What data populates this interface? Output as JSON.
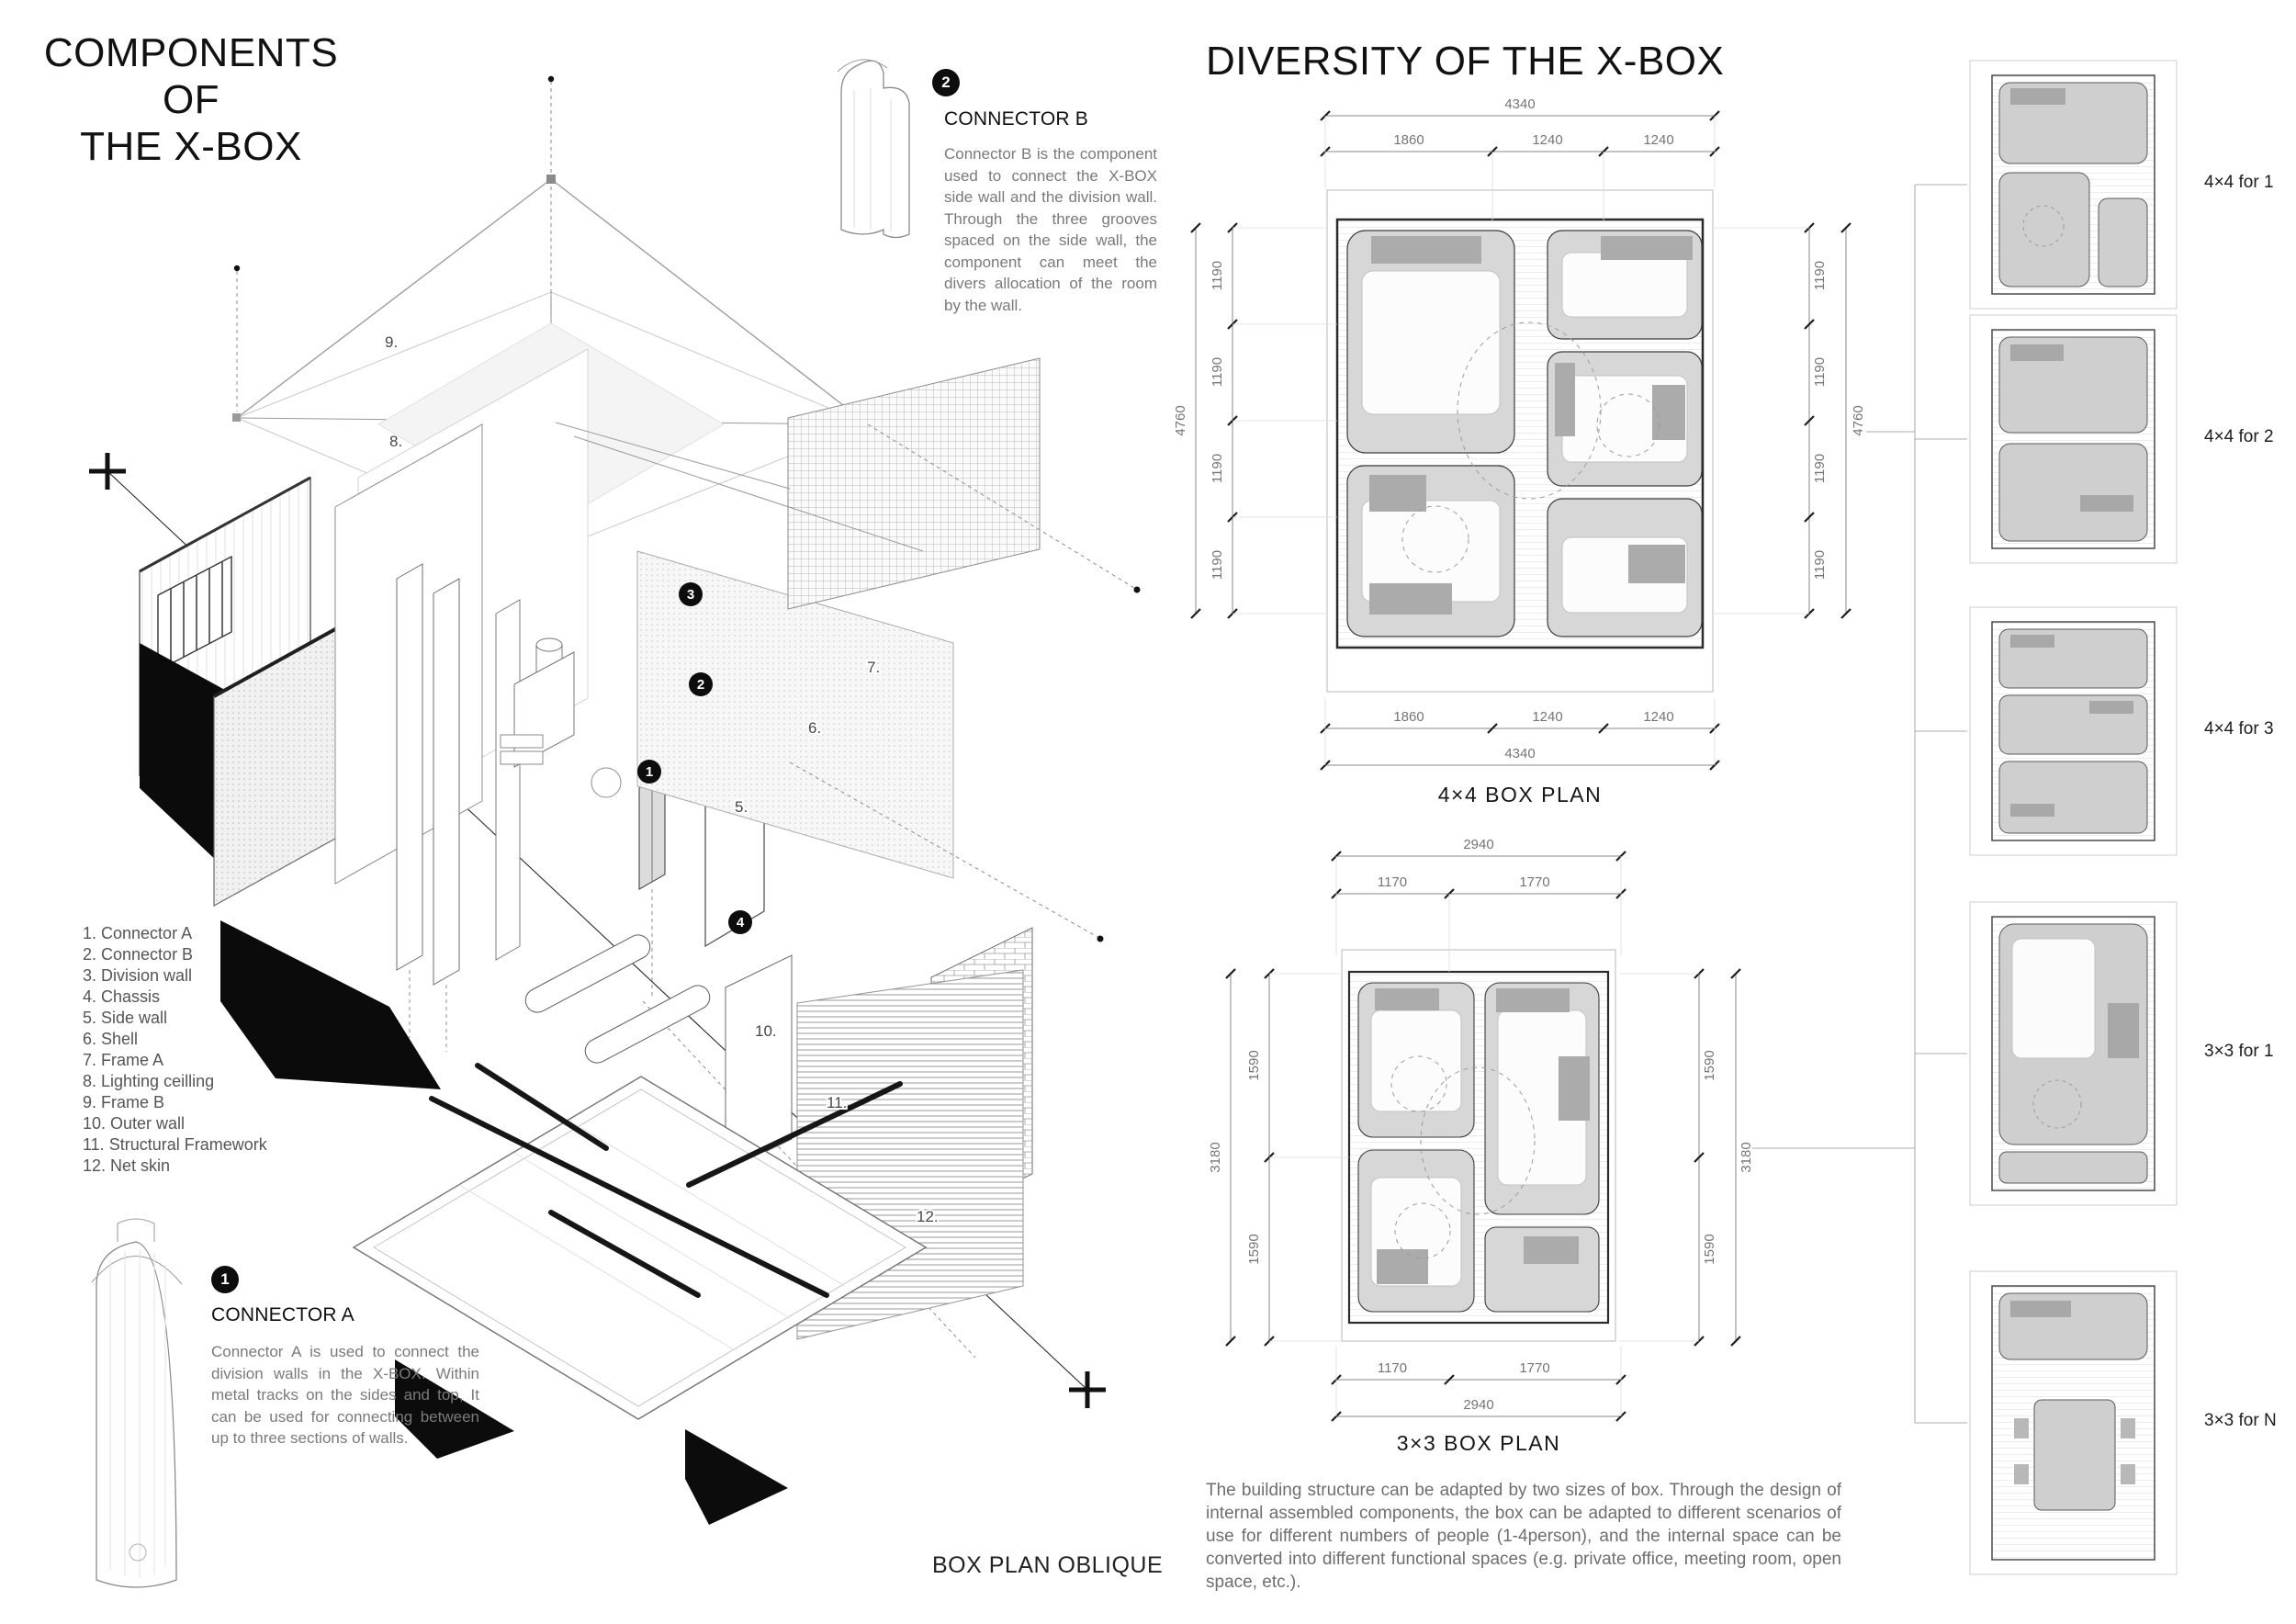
{
  "components": {
    "title1": "COMPONENTS OF",
    "title2": "THE X-BOX",
    "parts_list": [
      "1. Connector A",
      "2. Connector B",
      "3. Division wall",
      "4. Chassis",
      "5. Side wall",
      "6. Shell",
      "7. Frame A",
      "8. Lighting ceilling",
      "9. Frame B",
      "10. Outer wall",
      "11. Structural Framework",
      "12. Net skin"
    ],
    "connector_b": {
      "badge": "2",
      "heading": "CONNECTOR B",
      "body": "Connector B is the component used to connect the X-BOX side wall and the division wall. Through the three grooves spaced on the side wall, the component can meet the divers allocation of the room by the wall."
    },
    "connector_a": {
      "badge": "1",
      "heading": "CONNECTOR A",
      "body": "Connector A is used to connect the division walls in the X-BOX. Within metal tracks on the sides and top, It can be used for connecting between up to three sections of walls."
    },
    "callouts": {
      "badges": [
        "1",
        "2",
        "3",
        "4"
      ],
      "plain": [
        "5.",
        "6.",
        "7.",
        "8.",
        "9.",
        "10.",
        "11.",
        "12."
      ]
    },
    "oblique_label": "BOX PLAN OBLIQUE"
  },
  "diversity": {
    "title": "DIVERSITY OF THE X-BOX",
    "plan44": {
      "label": "4×4 BOX PLAN",
      "total_w": "4340",
      "top": [
        "1860",
        "1240",
        "1240"
      ],
      "total_h": "4760",
      "side": [
        "1190",
        "1190",
        "1190",
        "1190"
      ]
    },
    "plan33": {
      "label": "3×3 BOX PLAN",
      "total_w": "2940",
      "top": [
        "1170",
        "1770"
      ],
      "total_h": "3180",
      "side": [
        "1590",
        "1590"
      ]
    },
    "variants": [
      "4×4 for 1",
      "4×4 for 2",
      "4×4 for 3",
      "3×3 for 1",
      "3×3 for N"
    ],
    "description": "The building structure can be adapted by two sizes of box. Through the design of internal assembled components, the box can be adapted to different scenarios of use for different numbers of people (1-4person), and the internal space can be converted into different functional spaces (e.g. private office, meeting room, open space, etc.)."
  }
}
